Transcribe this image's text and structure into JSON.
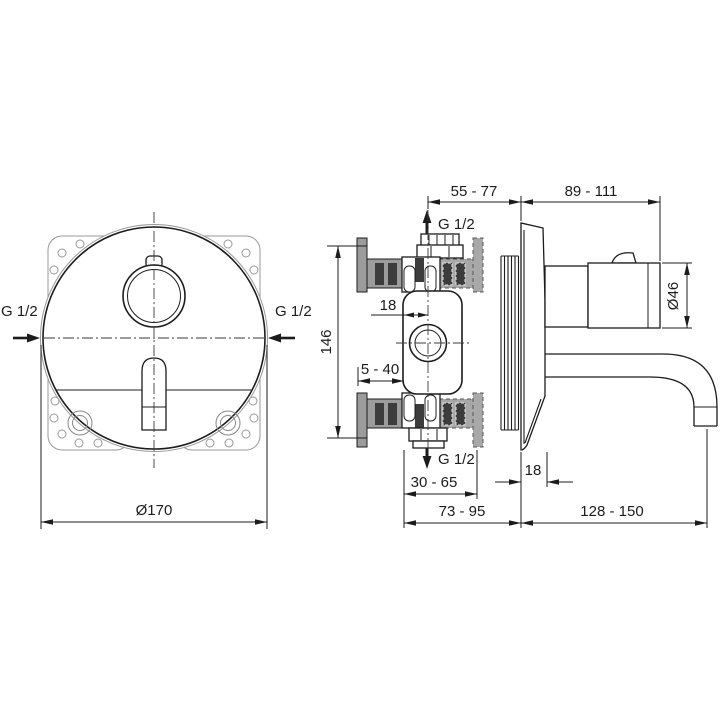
{
  "drawing": {
    "front_view": {
      "inlet_left": "G 1/2",
      "inlet_right": "G 1/2",
      "plate_diameter": "Ø170"
    },
    "side_view": {
      "dim_axis_to_wall": "55 - 77",
      "dim_wall_to_body_end": "89 - 111",
      "inlet_top": "G 1/2",
      "dim_axis_offset": "18",
      "dim_frame_height": "146",
      "dim_mounting_depth_range": "5 - 40",
      "inlet_bottom": "G 1/2",
      "dim_body_to_unfinished_wall": "30 - 65",
      "dim_plate_thickness": "18",
      "dim_body_to_finished_wall": "73 - 95",
      "dim_spout_reach": "128 - 150",
      "body_diameter": "Ø46"
    },
    "colors": {
      "line": "#1c1c1c",
      "rail_gray": "#9c9c9c",
      "slot_dark": "#3c3c3c",
      "hidden_gray": "#a8a8a8",
      "background": "#ffffff"
    }
  }
}
